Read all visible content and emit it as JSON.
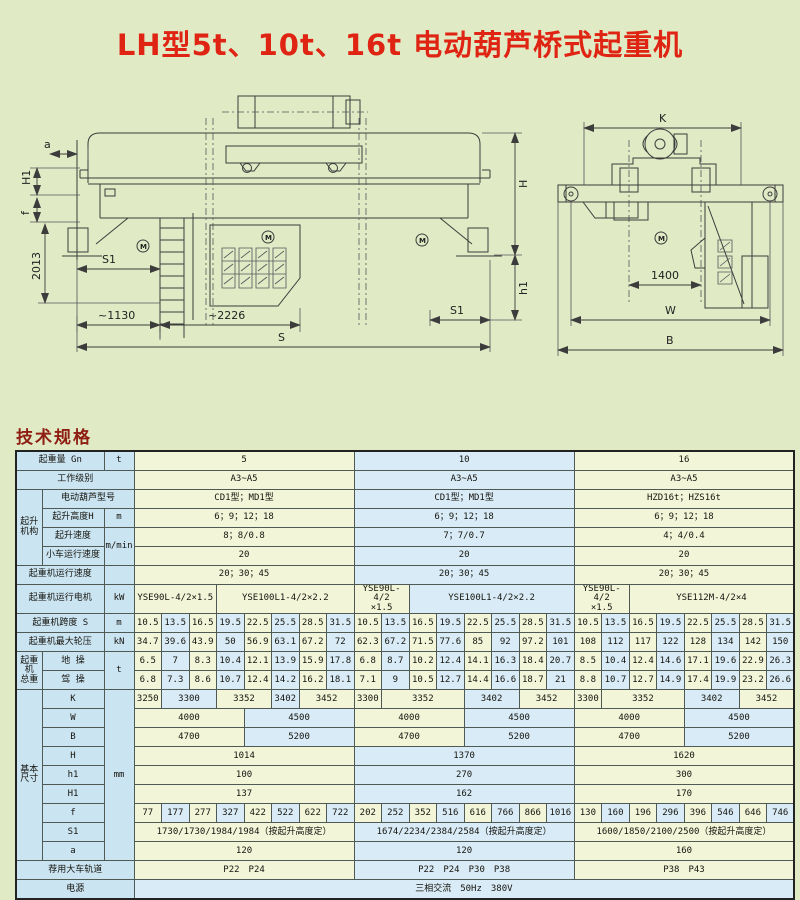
{
  "page": {
    "title": "LH型5t、10t、16t 电动葫芦桥式起重机",
    "spec_heading": "技术规格"
  },
  "colors": {
    "page_bg": "#e0eac5",
    "title_red": "#e02413",
    "heading_red": "#8e1d12",
    "cell_yellow": "#f2f5d8",
    "cell_blue": "#d9ebf6",
    "header_blue": "#cbe4f1",
    "line": "#3c3c3c"
  },
  "drawing": {
    "motor_mark": "M",
    "left": {
      "dim_a": "a",
      "dim_H1": "H1",
      "dim_f": "f",
      "dim_2013": "2013",
      "dim_S1_left": "S1",
      "dim_1130": "~1130",
      "dim_2226": "~2226",
      "dim_S": "S",
      "dim_H": "H",
      "dim_h1": "h1",
      "dim_S1_right": "S1"
    },
    "right": {
      "dim_K": "K",
      "dim_1400": "1400",
      "dim_W": "W",
      "dim_B": "B"
    }
  },
  "table": {
    "rows": [
      {
        "cells": [
          {
            "t": "起重量 Gn",
            "cs": 2,
            "c": "h"
          },
          {
            "t": "t",
            "c": "h"
          },
          {
            "t": "5",
            "cs": 8,
            "c": "y"
          },
          {
            "t": "10",
            "cs": 8,
            "c": "b"
          },
          {
            "t": "16",
            "cs": 8,
            "c": "y"
          }
        ]
      },
      {
        "cells": [
          {
            "t": "工作级别",
            "cs": 3,
            "c": "h"
          },
          {
            "t": "A3~A5",
            "cs": 8,
            "c": "y"
          },
          {
            "t": "A3~A5",
            "cs": 8,
            "c": "b"
          },
          {
            "t": "A3~A5",
            "cs": 8,
            "c": "y"
          }
        ]
      },
      {
        "cells": [
          {
            "t": "起升\n机构",
            "rs": 4,
            "c": "h",
            "f": "grp"
          },
          {
            "t": "电动葫芦型号",
            "cs": 2,
            "c": "h"
          },
          {
            "t": "CD1型；MD1型",
            "cs": 8,
            "c": "y"
          },
          {
            "t": "CD1型；MD1型",
            "cs": 8,
            "c": "b"
          },
          {
            "t": "HZD16t；HZS16t",
            "cs": 8,
            "c": "y"
          }
        ]
      },
      {
        "cells": [
          {
            "t": "起升高度H",
            "c": "h"
          },
          {
            "t": "m",
            "c": "h"
          },
          {
            "t": "6；9；12；18",
            "cs": 8,
            "c": "y"
          },
          {
            "t": "6；9；12；18",
            "cs": 8,
            "c": "b"
          },
          {
            "t": "6；9；12；18",
            "cs": 8,
            "c": "y"
          }
        ]
      },
      {
        "cells": [
          {
            "t": "起升速度",
            "c": "h"
          },
          {
            "t": "m/min",
            "rs": 2,
            "c": "h"
          },
          {
            "t": "8；8/0.8",
            "cs": 8,
            "c": "y"
          },
          {
            "t": "7；7/0.7",
            "cs": 8,
            "c": "b"
          },
          {
            "t": "4；4/0.4",
            "cs": 8,
            "c": "y"
          }
        ]
      },
      {
        "cells": [
          {
            "t": "小车运行速度",
            "c": "h",
            "f": "small"
          },
          {
            "t": "20",
            "cs": 8,
            "c": "y"
          },
          {
            "t": "20",
            "cs": 8,
            "c": "b"
          },
          {
            "t": "20",
            "cs": 8,
            "c": "y"
          }
        ]
      },
      {
        "cells": [
          {
            "t": "起重机运行速度",
            "cs": 2,
            "c": "h"
          },
          {
            "t": "",
            "c": "h"
          },
          {
            "t": "20；30；45",
            "cs": 8,
            "c": "y"
          },
          {
            "t": "20；30；45",
            "cs": 8,
            "c": "b"
          },
          {
            "t": "20；30；45",
            "cs": 8,
            "c": "y"
          }
        ]
      },
      {
        "cells": [
          {
            "t": "起重机运行电机",
            "cs": 2,
            "c": "h"
          },
          {
            "t": "kW",
            "c": "h"
          },
          {
            "t": "YSE90L-4/2×1.5",
            "cs": 3,
            "c": "y"
          },
          {
            "t": "YSE100L1-4/2×2.2",
            "cs": 5,
            "c": "y"
          },
          {
            "t": "YSE90L-4/2\n×1.5",
            "cs": 2,
            "c": "y",
            "f": "small"
          },
          {
            "t": "YSE100L1-4/2×2.2",
            "cs": 6,
            "c": "b"
          },
          {
            "t": "YSE90L-4/2\n×1.5",
            "cs": 2,
            "c": "y",
            "f": "small"
          },
          {
            "t": "YSE112M-4/2×4",
            "cs": 6,
            "c": "y"
          }
        ]
      },
      {
        "cells": [
          {
            "t": "起重机跨度 S",
            "cs": 2,
            "c": "h"
          },
          {
            "t": "m",
            "c": "h"
          },
          {
            "t": "10.5",
            "c": "y"
          },
          {
            "t": "13.5",
            "c": "b"
          },
          {
            "t": "16.5",
            "c": "y"
          },
          {
            "t": "19.5",
            "c": "b"
          },
          {
            "t": "22.5",
            "c": "y"
          },
          {
            "t": "25.5",
            "c": "b"
          },
          {
            "t": "28.5",
            "c": "y"
          },
          {
            "t": "31.5",
            "c": "b"
          },
          {
            "t": "10.5",
            "c": "y"
          },
          {
            "t": "13.5",
            "c": "b"
          },
          {
            "t": "16.5",
            "c": "y"
          },
          {
            "t": "19.5",
            "c": "b"
          },
          {
            "t": "22.5",
            "c": "y"
          },
          {
            "t": "25.5",
            "c": "b"
          },
          {
            "t": "28.5",
            "c": "y"
          },
          {
            "t": "31.5",
            "c": "b"
          },
          {
            "t": "10.5",
            "c": "y"
          },
          {
            "t": "13.5",
            "c": "b"
          },
          {
            "t": "16.5",
            "c": "y"
          },
          {
            "t": "19.5",
            "c": "b"
          },
          {
            "t": "22.5",
            "c": "y"
          },
          {
            "t": "25.5",
            "c": "b"
          },
          {
            "t": "28.5",
            "c": "y"
          },
          {
            "t": "31.5",
            "c": "b"
          }
        ]
      },
      {
        "cells": [
          {
            "t": "起重机最大轮压",
            "cs": 2,
            "c": "h"
          },
          {
            "t": "kN",
            "c": "h"
          },
          {
            "t": "34.7",
            "c": "y"
          },
          {
            "t": "39.6",
            "c": "b"
          },
          {
            "t": "43.9",
            "c": "y"
          },
          {
            "t": "50",
            "c": "b"
          },
          {
            "t": "56.9",
            "c": "y"
          },
          {
            "t": "63.1",
            "c": "b"
          },
          {
            "t": "67.2",
            "c": "y"
          },
          {
            "t": "72",
            "c": "b"
          },
          {
            "t": "62.3",
            "c": "y"
          },
          {
            "t": "67.2",
            "c": "b"
          },
          {
            "t": "71.5",
            "c": "y"
          },
          {
            "t": "77.6",
            "c": "b"
          },
          {
            "t": "85",
            "c": "y"
          },
          {
            "t": "92",
            "c": "b"
          },
          {
            "t": "97.2",
            "c": "y"
          },
          {
            "t": "101",
            "c": "b"
          },
          {
            "t": "108",
            "c": "y"
          },
          {
            "t": "112",
            "c": "b"
          },
          {
            "t": "117",
            "c": "y"
          },
          {
            "t": "122",
            "c": "b"
          },
          {
            "t": "128",
            "c": "y"
          },
          {
            "t": "134",
            "c": "b"
          },
          {
            "t": "142",
            "c": "y"
          },
          {
            "t": "150",
            "c": "b"
          }
        ]
      },
      {
        "cells": [
          {
            "t": "起重机\n总重",
            "rs": 2,
            "c": "h",
            "f": "grp"
          },
          {
            "t": "地 操",
            "c": "h"
          },
          {
            "t": "t",
            "rs": 2,
            "c": "h"
          },
          {
            "t": "6.5",
            "c": "y"
          },
          {
            "t": "7",
            "c": "b"
          },
          {
            "t": "8.3",
            "c": "y"
          },
          {
            "t": "10.4",
            "c": "b"
          },
          {
            "t": "12.1",
            "c": "y"
          },
          {
            "t": "13.9",
            "c": "b"
          },
          {
            "t": "15.9",
            "c": "y"
          },
          {
            "t": "17.8",
            "c": "b"
          },
          {
            "t": "6.8",
            "c": "y"
          },
          {
            "t": "8.7",
            "c": "b"
          },
          {
            "t": "10.2",
            "c": "y"
          },
          {
            "t": "12.4",
            "c": "b"
          },
          {
            "t": "14.1",
            "c": "y"
          },
          {
            "t": "16.3",
            "c": "b"
          },
          {
            "t": "18.4",
            "c": "y"
          },
          {
            "t": "20.7",
            "c": "b"
          },
          {
            "t": "8.5",
            "c": "y"
          },
          {
            "t": "10.4",
            "c": "b"
          },
          {
            "t": "12.4",
            "c": "y"
          },
          {
            "t": "14.6",
            "c": "b"
          },
          {
            "t": "17.1",
            "c": "y"
          },
          {
            "t": "19.6",
            "c": "b"
          },
          {
            "t": "22.9",
            "c": "y"
          },
          {
            "t": "26.3",
            "c": "b"
          }
        ]
      },
      {
        "cells": [
          {
            "t": "驾 操",
            "c": "h"
          },
          {
            "t": "6.8",
            "c": "y"
          },
          {
            "t": "7.3",
            "c": "b"
          },
          {
            "t": "8.6",
            "c": "y"
          },
          {
            "t": "10.7",
            "c": "b"
          },
          {
            "t": "12.4",
            "c": "y"
          },
          {
            "t": "14.2",
            "c": "b"
          },
          {
            "t": "16.2",
            "c": "y"
          },
          {
            "t": "18.1",
            "c": "b"
          },
          {
            "t": "7.1",
            "c": "y"
          },
          {
            "t": "9",
            "c": "b"
          },
          {
            "t": "10.5",
            "c": "y"
          },
          {
            "t": "12.7",
            "c": "b"
          },
          {
            "t": "14.4",
            "c": "y"
          },
          {
            "t": "16.6",
            "c": "b"
          },
          {
            "t": "18.7",
            "c": "y"
          },
          {
            "t": "21",
            "c": "b"
          },
          {
            "t": "8.8",
            "c": "y"
          },
          {
            "t": "10.7",
            "c": "b"
          },
          {
            "t": "12.7",
            "c": "y"
          },
          {
            "t": "14.9",
            "c": "b"
          },
          {
            "t": "17.4",
            "c": "y"
          },
          {
            "t": "19.9",
            "c": "b"
          },
          {
            "t": "23.2",
            "c": "y"
          },
          {
            "t": "26.6",
            "c": "b"
          }
        ]
      },
      {
        "cells": [
          {
            "t": "基本\n尺寸",
            "rs": 9,
            "c": "h",
            "f": "grp"
          },
          {
            "t": "K",
            "c": "h"
          },
          {
            "t": "mm",
            "rs": 9,
            "c": "h"
          },
          {
            "t": "3250",
            "c": "y"
          },
          {
            "t": "3300",
            "cs": 2,
            "c": "b"
          },
          {
            "t": "3352",
            "cs": 2,
            "c": "y"
          },
          {
            "t": "3402",
            "c": "b"
          },
          {
            "t": "3452",
            "cs": 2,
            "c": "y"
          },
          {
            "t": "3300",
            "c": "y"
          },
          {
            "t": "3352",
            "cs": 3,
            "c": "y"
          },
          {
            "t": "3402",
            "cs": 2,
            "c": "b"
          },
          {
            "t": "3452",
            "cs": 2,
            "c": "y"
          },
          {
            "t": "3300",
            "c": "y"
          },
          {
            "t": "3352",
            "cs": 3,
            "c": "y"
          },
          {
            "t": "3402",
            "cs": 2,
            "c": "b"
          },
          {
            "t": "3452",
            "cs": 2,
            "c": "y"
          }
        ]
      },
      {
        "cells": [
          {
            "t": "W",
            "c": "h"
          },
          {
            "t": "4000",
            "cs": 4,
            "c": "y"
          },
          {
            "t": "4500",
            "cs": 4,
            "c": "b"
          },
          {
            "t": "4000",
            "cs": 4,
            "c": "y"
          },
          {
            "t": "4500",
            "cs": 4,
            "c": "b"
          },
          {
            "t": "4000",
            "cs": 4,
            "c": "y"
          },
          {
            "t": "4500",
            "cs": 4,
            "c": "b"
          }
        ]
      },
      {
        "cells": [
          {
            "t": "B",
            "c": "h"
          },
          {
            "t": "4700",
            "cs": 4,
            "c": "y"
          },
          {
            "t": "5200",
            "cs": 4,
            "c": "b"
          },
          {
            "t": "4700",
            "cs": 4,
            "c": "y"
          },
          {
            "t": "5200",
            "cs": 4,
            "c": "b"
          },
          {
            "t": "4700",
            "cs": 4,
            "c": "y"
          },
          {
            "t": "5200",
            "cs": 4,
            "c": "b"
          }
        ]
      },
      {
        "cells": [
          {
            "t": "H",
            "c": "h"
          },
          {
            "t": "1014",
            "cs": 8,
            "c": "y"
          },
          {
            "t": "1370",
            "cs": 8,
            "c": "b"
          },
          {
            "t": "1620",
            "cs": 8,
            "c": "y"
          }
        ]
      },
      {
        "cells": [
          {
            "t": "h1",
            "c": "h"
          },
          {
            "t": "100",
            "cs": 8,
            "c": "y"
          },
          {
            "t": "270",
            "cs": 8,
            "c": "b"
          },
          {
            "t": "300",
            "cs": 8,
            "c": "y"
          }
        ]
      },
      {
        "cells": [
          {
            "t": "H1",
            "c": "h"
          },
          {
            "t": "137",
            "cs": 8,
            "c": "y"
          },
          {
            "t": "162",
            "cs": 8,
            "c": "b"
          },
          {
            "t": "170",
            "cs": 8,
            "c": "y"
          }
        ]
      },
      {
        "cells": [
          {
            "t": "f",
            "c": "h"
          },
          {
            "t": "77",
            "c": "y"
          },
          {
            "t": "177",
            "c": "b"
          },
          {
            "t": "277",
            "c": "y"
          },
          {
            "t": "327",
            "c": "b"
          },
          {
            "t": "422",
            "c": "y"
          },
          {
            "t": "522",
            "c": "b"
          },
          {
            "t": "622",
            "c": "y"
          },
          {
            "t": "722",
            "c": "b"
          },
          {
            "t": "202",
            "c": "y"
          },
          {
            "t": "252",
            "c": "b"
          },
          {
            "t": "352",
            "c": "y"
          },
          {
            "t": "516",
            "c": "b"
          },
          {
            "t": "616",
            "c": "y"
          },
          {
            "t": "766",
            "c": "b"
          },
          {
            "t": "866",
            "c": "y"
          },
          {
            "t": "1016",
            "c": "b"
          },
          {
            "t": "130",
            "c": "y"
          },
          {
            "t": "160",
            "c": "b"
          },
          {
            "t": "196",
            "c": "y"
          },
          {
            "t": "296",
            "c": "b"
          },
          {
            "t": "396",
            "c": "y"
          },
          {
            "t": "546",
            "c": "b"
          },
          {
            "t": "646",
            "c": "y"
          },
          {
            "t": "746",
            "c": "b"
          }
        ]
      },
      {
        "cells": [
          {
            "t": "S1",
            "c": "h"
          },
          {
            "t": "1730/1730/1984/1984（按起升高度定）",
            "cs": 8,
            "c": "y"
          },
          {
            "t": "1674/2234/2384/2584（按起升高度定）",
            "cs": 8,
            "c": "b"
          },
          {
            "t": "1600/1850/2100/2500（按起升高度定）",
            "cs": 8,
            "c": "y"
          }
        ]
      },
      {
        "cells": [
          {
            "t": "a",
            "c": "h"
          },
          {
            "t": "120",
            "cs": 8,
            "c": "y"
          },
          {
            "t": "120",
            "cs": 8,
            "c": "b"
          },
          {
            "t": "160",
            "cs": 8,
            "c": "y"
          }
        ]
      },
      {
        "cells": [
          {
            "t": "荐用大车轨道",
            "cs": 3,
            "c": "h"
          },
          {
            "t": "P22　P24",
            "cs": 8,
            "c": "y"
          },
          {
            "t": "P22　P24　P30　P38",
            "cs": 8,
            "c": "b"
          },
          {
            "t": "P38　P43",
            "cs": 8,
            "c": "y"
          }
        ]
      },
      {
        "cells": [
          {
            "t": "电源",
            "cs": 3,
            "c": "h"
          },
          {
            "t": "三相交流　50Hz　380V",
            "cs": 24,
            "c": "b"
          }
        ]
      }
    ]
  }
}
